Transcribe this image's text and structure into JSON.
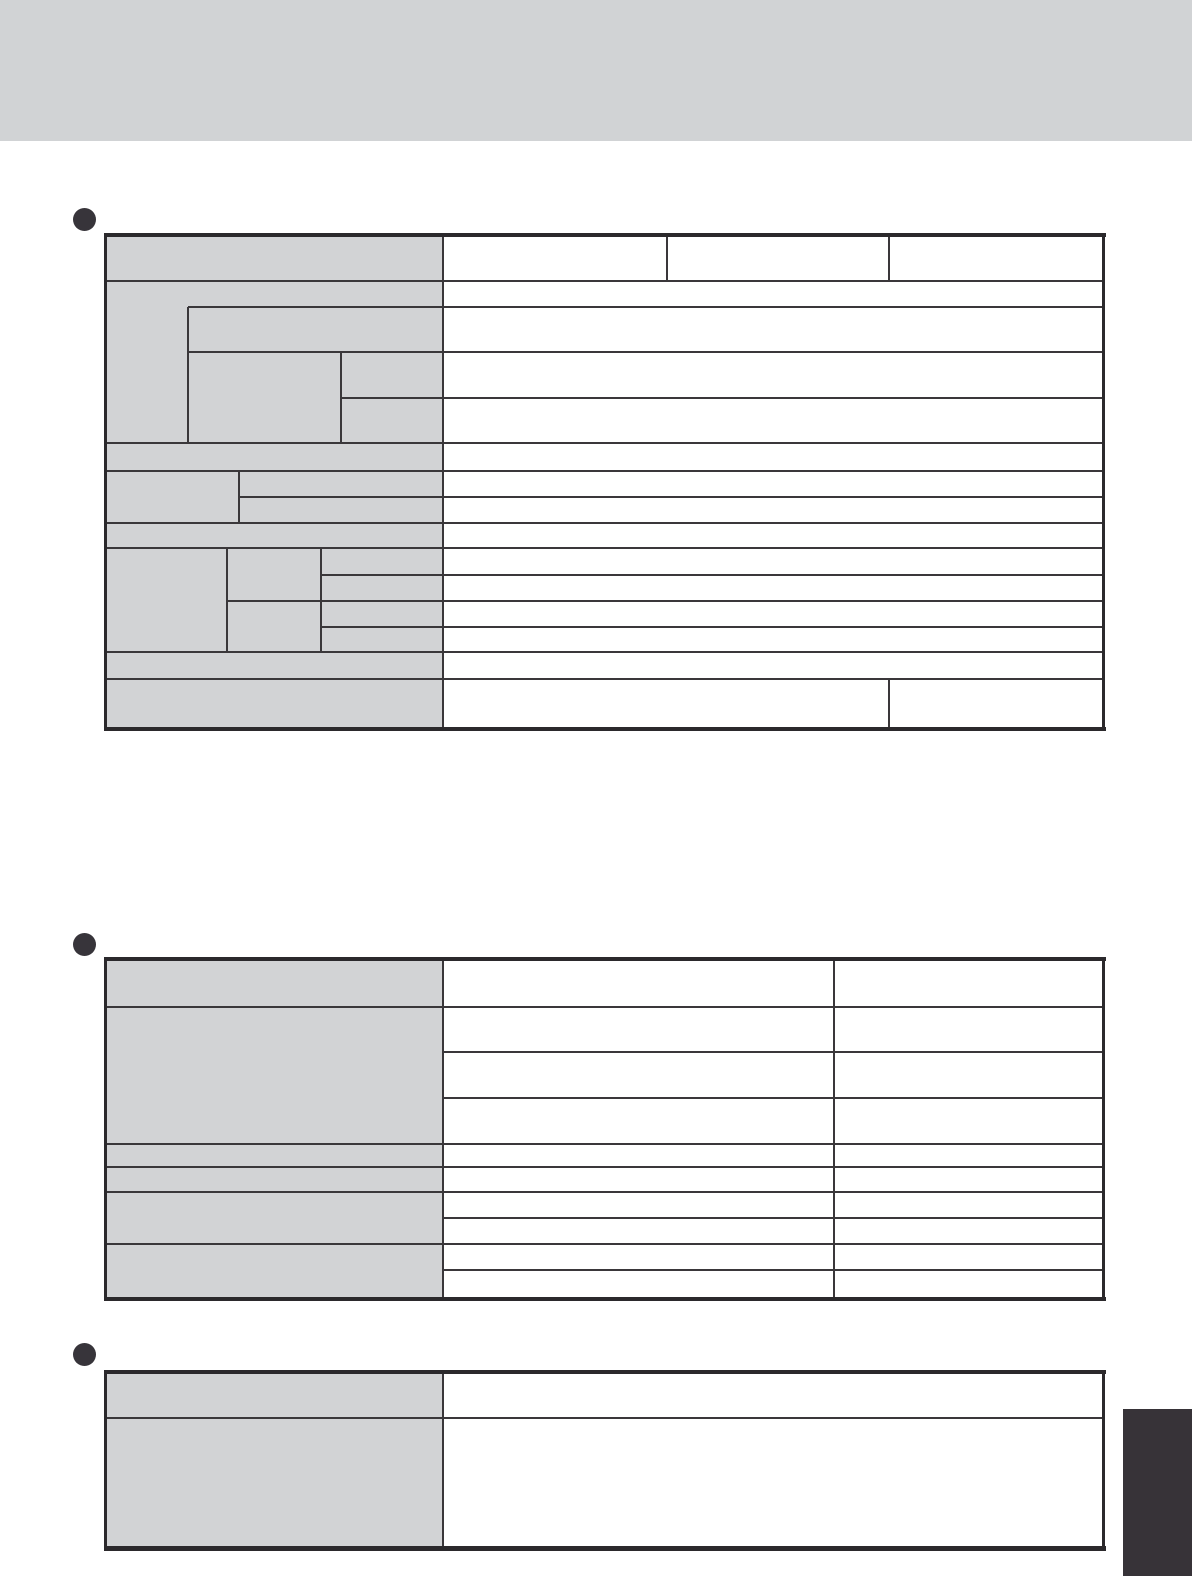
{
  "page": {
    "kind": "scanned-manual-specifications-page",
    "visible_text": "",
    "header_band_present": true,
    "side_tab_present": true
  },
  "colors": {
    "page": "#ffffff",
    "band": "#d1d3d5",
    "gray": "#d2d3d5",
    "line": "#3a373a",
    "outer": "#2b292c",
    "bullet": "#37343a",
    "tab": "#373338"
  },
  "sections": [
    {
      "name": "spec-table-1",
      "bullet_icon": "filled-circle",
      "header_columns": 3,
      "body_rows": 14,
      "all_cells_empty": true
    },
    {
      "name": "spec-table-2",
      "bullet_icon": "filled-circle",
      "header_columns": 2,
      "body_rows": 9,
      "all_cells_empty": true
    },
    {
      "name": "spec-table-3",
      "bullet_icon": "filled-circle",
      "header_columns": 1,
      "body_rows": 1,
      "all_cells_empty": true
    }
  ]
}
